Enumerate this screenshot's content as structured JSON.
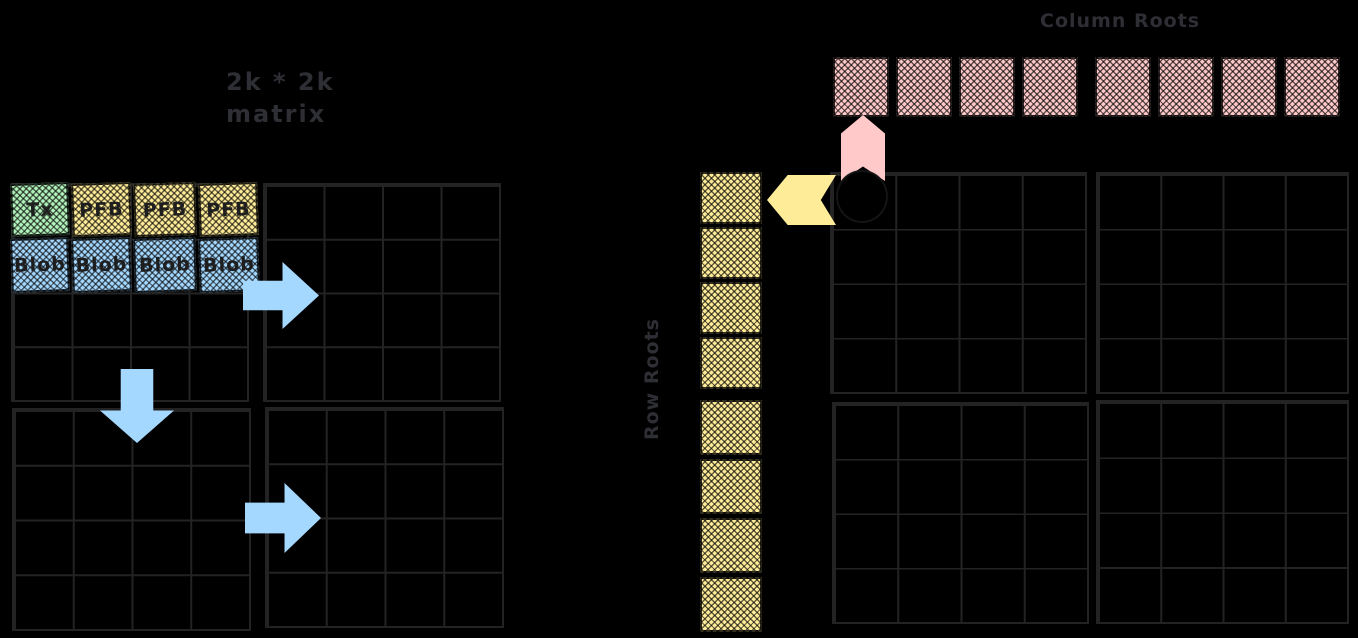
{
  "labels": {
    "matrix_size": "2k * 2k",
    "matrix_word": "matrix",
    "column_roots": "Column Roots",
    "row_roots": "Row Roots"
  },
  "matrix_blocks": {
    "row1": [
      {
        "label": "Tx",
        "color": "green"
      },
      {
        "label": "PFB",
        "color": "yellow"
      },
      {
        "label": "PFB",
        "color": "yellow"
      },
      {
        "label": "PFB",
        "color": "yellow"
      }
    ],
    "row2": [
      {
        "label": "Blob",
        "color": "blue"
      },
      {
        "label": "Blob",
        "color": "blue"
      },
      {
        "label": "Blob",
        "color": "blue"
      },
      {
        "label": "Blob",
        "color": "blue"
      }
    ]
  },
  "roots": {
    "column_cells": 8,
    "row_cells": 8
  },
  "grids": {
    "left_count": 4,
    "right_count": 4,
    "rows": 4,
    "cols": 4
  },
  "palette": {
    "background": "#000000",
    "grid_line": "#232323",
    "label_text": "#2e2e35",
    "block_text": "#1e1e1e",
    "green": "#b2f2bb",
    "yellow": "#ffec99",
    "blue": "#a5d8ff",
    "pink": "#ffc9c9",
    "arrow_blue": "#a5d8ff"
  }
}
